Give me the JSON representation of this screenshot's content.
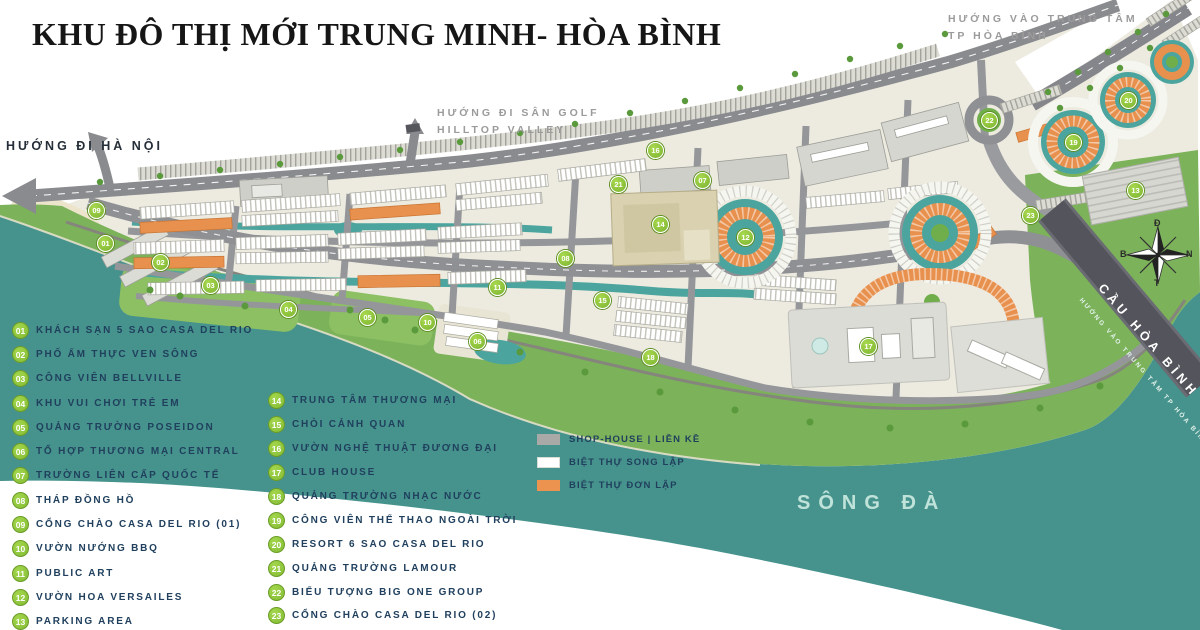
{
  "title": "KHU ĐÔ THỊ MỚI TRUNG MINH- HÒA BÌNH",
  "directions": {
    "hanoi": "HƯỚNG ĐI HÀ NỘI",
    "golf_line1": "HƯỚNG ĐI SÂN GOLF",
    "golf_line2": "HILLTOP VALLEY",
    "city_line1": "HƯỚNG VÀO TRUNG TÂM",
    "city_line2": "TP HÒA BÌNH"
  },
  "map_labels": {
    "river": "SÔNG ĐÀ",
    "bridge": "CẦU HÒA BÌNH",
    "bridge_sub": "HƯỚNG VÀO TRUNG TÂM TP HÒA BÌNH"
  },
  "compass": {
    "top": "Đ",
    "right": "N",
    "bottom": "T",
    "left": "B"
  },
  "legend": {
    "items": [
      {
        "num": "01",
        "label": "KHÁCH SẠN 5 SAO CASA DEL RIO"
      },
      {
        "num": "02",
        "label": "PHỐ ẨM THỰC VEN SÔNG"
      },
      {
        "num": "03",
        "label": "CÔNG VIÊN BELLVILLE"
      },
      {
        "num": "04",
        "label": "KHU VUI CHƠI TRẺ EM"
      },
      {
        "num": "05",
        "label": "QUẢNG TRƯỜNG POSEIDON"
      },
      {
        "num": "06",
        "label": "TỔ HỢP THƯƠNG MẠI CENTRAL"
      },
      {
        "num": "07",
        "label": "TRƯỜNG LIÊN CẤP QUỐC TẾ"
      },
      {
        "num": "08",
        "label": "THÁP ĐỒNG HỒ"
      },
      {
        "num": "09",
        "label": "CỔNG CHÀO CASA DEL RIO (01)"
      },
      {
        "num": "10",
        "label": "VƯỜN NƯỚNG BBQ"
      },
      {
        "num": "11",
        "label": "PUBLIC ART"
      },
      {
        "num": "12",
        "label": "VƯỜN HOA VERSAILES"
      },
      {
        "num": "13",
        "label": "PARKING AREA"
      },
      {
        "num": "14",
        "label": "TRUNG TÂM THƯƠNG MẠI"
      },
      {
        "num": "15",
        "label": "CHÒI CẢNH QUAN"
      },
      {
        "num": "16",
        "label": "VƯỜN NGHỆ THUẬT ĐƯƠNG ĐẠI"
      },
      {
        "num": "17",
        "label": "CLUB HOUSE"
      },
      {
        "num": "18",
        "label": "QUẢNG TRƯỜNG NHẠC NƯỚC"
      },
      {
        "num": "19",
        "label": "CÔNG VIÊN THỂ THAO NGOÀI TRỜI"
      },
      {
        "num": "20",
        "label": "RESORT 6 SAO CASA DEL RIO"
      },
      {
        "num": "21",
        "label": "QUẢNG TRƯỜNG LAMOUR"
      },
      {
        "num": "22",
        "label": "BIỂU TƯỢNG BIG ONE GROUP"
      },
      {
        "num": "23",
        "label": "CỔNG CHÀO CASA DEL RIO (02)"
      }
    ],
    "types": [
      {
        "color": "#a9a9a7",
        "label": "SHOP-HOUSE | LIỀN KỀ"
      },
      {
        "color": "#ffffff",
        "label": "BIỆT THỰ SONG LẬP"
      },
      {
        "color": "#ec9350",
        "label": "BIỆT THỰ ĐƠN LẬP"
      }
    ]
  },
  "colors": {
    "river": "#46938d",
    "green_band": "#7cb25a",
    "road": "#909196",
    "orange_villa": "#e8914e",
    "badge_green": "#84bc35",
    "bridge": "#54545c"
  },
  "markers": [
    {
      "num": "01"
    },
    {
      "num": "02"
    },
    {
      "num": "03"
    },
    {
      "num": "04"
    },
    {
      "num": "05"
    },
    {
      "num": "06"
    },
    {
      "num": "07"
    },
    {
      "num": "08"
    },
    {
      "num": "09"
    },
    {
      "num": "10"
    },
    {
      "num": "11"
    },
    {
      "num": "12"
    },
    {
      "num": "13"
    },
    {
      "num": "14"
    },
    {
      "num": "15"
    },
    {
      "num": "16"
    },
    {
      "num": "17"
    },
    {
      "num": "18"
    },
    {
      "num": "19"
    },
    {
      "num": "20"
    },
    {
      "num": "21"
    },
    {
      "num": "22"
    },
    {
      "num": "23"
    }
  ]
}
